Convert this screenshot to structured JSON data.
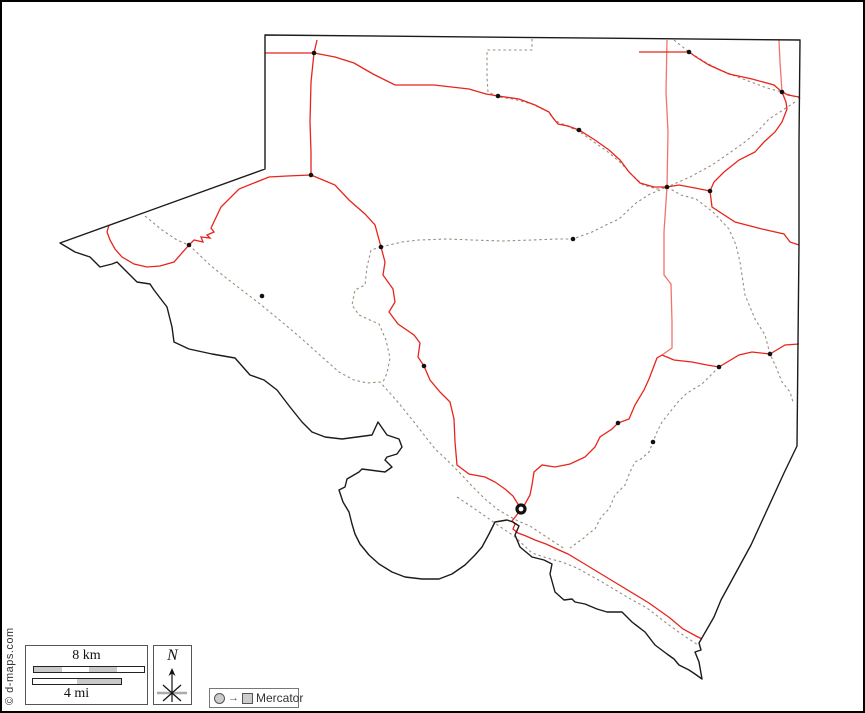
{
  "frame": {
    "background": "#ffffff",
    "border_color": "#000000"
  },
  "attribution": {
    "text": "© d-maps.com"
  },
  "legend": {
    "scale": {
      "km_label": "8 km",
      "mi_label": "4 mi"
    },
    "north": {
      "label": "N"
    },
    "projection": {
      "label": "Mercator",
      "symbols": [
        "circle",
        "arrow",
        "square"
      ]
    }
  },
  "map": {
    "colors": {
      "outline": "#1b1b1b",
      "road": "#e8241c",
      "road_light": "#f2736a",
      "dashed": "#9c8c7c",
      "town": "#111111"
    },
    "county_outline_d": "M 263,33 L 798,38 L 797,140 L 797,243 L 796,341 L 795,444 L 782,471 L 749,543 L 719,598 L 712,615 L 697,641 L 699,648 L 693,650 L 697,660 L 700,677 L 693,672 L 687,668 L 677,663 L 672,657 L 665,652 L 653,643 L 643,630 L 630,620 L 620,610 L 605,610 L 595,607 L 583,602 L 573,600 L 570,597 L 562,598 L 553,590 L 548,572 L 550,562 L 542,558 L 530,555 L 518,545 L 513,533 L 517,524 L 511,520 L 505,518 L 493,520 L 487,532 L 480,545 L 473,553 L 463,563 L 450,572 L 437,577 L 420,577 L 403,575 L 390,570 L 377,562 L 367,553 L 358,542 L 353,532 L 350,522 L 347,510 L 341,500 L 337,488 L 343,485 L 345,477 L 357,470 L 360,467 L 383,470 L 390,465 L 383,458 L 385,455 L 395,452 L 400,445 L 397,437 L 385,433 L 376,420 L 370,433 L 340,437 L 323,435 L 310,430 L 300,420 L 288,405 L 275,388 L 262,378 L 248,373 L 233,356 L 210,352 L 187,347 L 172,340 L 170,325 L 165,305 L 152,288 L 148,282 L 135,280 L 127,272 L 115,260 L 110,262 L 98,265 L 88,255 L 73,250 L 58,241 L 263,167 Z",
    "red_roads": [
      "M 263,51 L 312,51",
      "M 315,38 L 312,51 L 309,80 L 308,120 L 309,150 L 309,173",
      "M 312,51 L 333,55 L 352,61 L 371,72 L 393,83 L 432,83 L 467,87 L 484,92 L 496,94 L 517,97 L 533,103 L 547,110 L 551,116 L 556,122 L 566,124 L 577,128 L 593,138 L 607,148 L 618,158 L 627,170 L 638,181 L 652,185 L 665,185",
      "M 309,173 L 285,174 L 267,175 L 237,187 L 219,205 L 209,226 L 212,230 L 205,233 L 208,236 L 199,235 L 201,240 L 192,238 L 187,243 L 172,260 L 158,264 L 145,265 L 132,262 L 120,255 L 113,247 L 108,238 L 105,230 L 107,223",
      "M 309,173 L 333,183 L 347,198 L 363,212 L 373,223 L 379,245 L 383,260 L 381,273 L 391,287 L 393,300 L 387,310 L 396,322 L 412,333 L 418,341 L 416,355 L 422,364 L 428,378 L 438,390 L 448,400 L 452,417 L 453,440 L 455,463 L 467,472 L 483,475 L 493,480 L 503,487 L 511,494 L 519,507",
      "M 660,353 L 655,356 L 647,377 L 642,388 L 633,403 L 627,417 L 616,421 L 610,427 L 598,435 L 593,445 L 583,455 L 568,462 L 553,465 L 540,463 L 532,470 L 530,483 L 528,493 L 523,502 L 519,507",
      "M 660,353 L 672,358 L 690,360 L 705,363 L 717,365 L 737,353 L 750,350 L 768,352 L 783,343 L 797,342",
      "M 665,185 L 677,183 L 693,186 L 708,189 L 710,205 L 733,220 L 760,227 L 782,232 L 788,240 L 797,243",
      "M 637,50 L 687,50 L 694,55 L 707,63 L 727,72 L 750,77 L 772,83 L 780,90 L 786,93 L 797,95",
      "M 780,90 L 784,100 L 785,107 L 780,120 L 773,130 L 762,140 L 753,150 L 737,158 L 722,170 L 712,180 L 708,189",
      "M 519,507 L 514,514 L 510,519 L 513,522 L 511,527 L 516,531 L 524,534 L 533,538 L 544,542 L 557,548 L 566,552 L 581,561 L 614,581 L 647,601 L 668,616 L 681,627 L 694,634 L 700,637"
    ],
    "light_red_roads": [
      "M 665,38 L 664,90 L 666,130 L 665,185 L 662,230 L 662,273 L 669,282 L 670,320 L 670,346 L 660,353",
      "M 777,38 L 778,60 L 779,75 L 780,90"
    ],
    "dashed_roads": [
      "M 143,214 L 160,228 L 175,238 L 187,243 L 209,264 L 232,282 L 258,302 L 280,320 L 300,337 L 320,355 L 337,370 L 352,378 L 365,381 L 378,380 L 395,399 L 412,420 L 426,438 L 433,447 L 445,458 L 457,470 L 470,484 L 483,497 L 495,507 L 505,513 L 516,519 L 528,524 L 540,532 L 552,540 L 563,547",
      "M 530,37 L 530,48 L 485,48 L 485,75 L 486,90 L 497,95 L 511,97 L 530,102 L 545,109 L 554,119 L 565,124 L 578,130 L 592,140 L 606,150 L 619,161 L 629,172 L 641,183 L 655,187 L 665,185",
      "M 672,38 L 687,50 L 703,60 L 716,67 L 733,74 L 749,80 L 765,86 L 780,90 L 791,94 L 800,97",
      "M 793,100 L 778,110 L 767,117 L 755,130 L 743,140 L 726,152 L 710,163 L 688,175 L 672,182 L 665,185",
      "M 665,185 L 679,193 L 694,197 L 711,210 L 727,227 L 734,243 L 738,260 L 743,293 L 753,317 L 763,333 L 768,352 L 774,365 L 780,380 L 788,390 L 791,400",
      "M 379,245 L 400,240 L 417,238 L 445,237 L 470,238 L 500,239 L 530,238 L 555,237 L 571,237 L 590,230 L 606,222 L 617,217 L 634,201 L 648,192 L 665,185",
      "M 379,245 L 369,248 L 365,265 L 363,283 L 353,288 L 350,303 L 357,313 L 370,319 L 377,322 L 384,338 L 388,356 L 385,371 L 381,380",
      "M 717,365 L 709,373 L 700,382 L 690,388 L 684,392 L 676,400 L 668,410 L 660,420 L 655,430 L 651,440 L 647,450 L 639,457 L 633,460 L 628,470 L 623,483 L 617,489 L 613,493 L 607,507 L 601,513 L 598,517 L 593,527 L 586,532 L 583,535 L 575,541 L 568,546",
      "M 455,495 L 470,505 L 483,514 L 497,524 L 512,534 L 530,551 L 545,556 L 560,560 L 575,566 L 600,580 L 625,595 L 645,606 L 663,620 L 678,631 L 690,639 L 696,643"
    ],
    "towns": [
      {
        "x": 312,
        "y": 51
      },
      {
        "x": 496,
        "y": 94
      },
      {
        "x": 577,
        "y": 128
      },
      {
        "x": 687,
        "y": 50
      },
      {
        "x": 780,
        "y": 90
      },
      {
        "x": 665,
        "y": 185
      },
      {
        "x": 708,
        "y": 189
      },
      {
        "x": 571,
        "y": 237
      },
      {
        "x": 309,
        "y": 173
      },
      {
        "x": 187,
        "y": 243
      },
      {
        "x": 379,
        "y": 245
      },
      {
        "x": 260,
        "y": 294
      },
      {
        "x": 422,
        "y": 364
      },
      {
        "x": 717,
        "y": 365
      },
      {
        "x": 768,
        "y": 352
      },
      {
        "x": 616,
        "y": 421
      },
      {
        "x": 651,
        "y": 440
      }
    ],
    "county_seat": {
      "x": 519,
      "y": 507
    }
  }
}
